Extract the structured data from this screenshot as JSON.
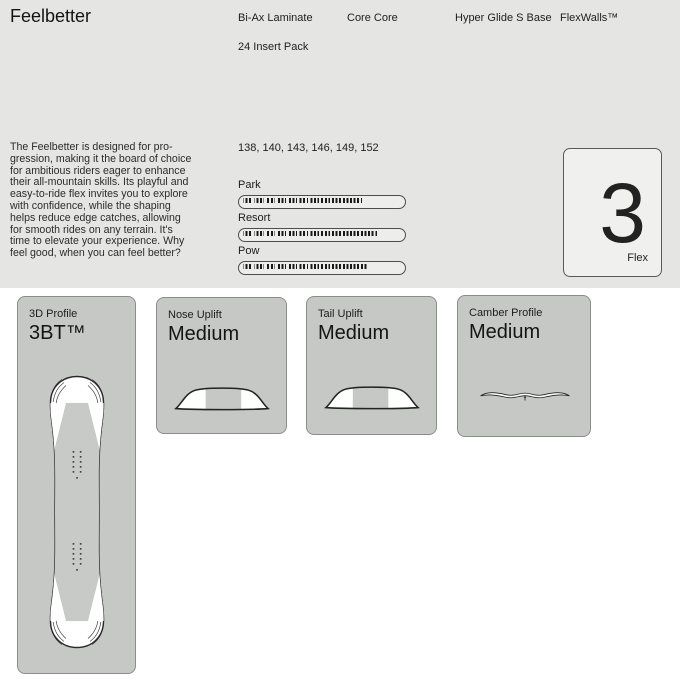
{
  "product": {
    "title": "Feelbetter",
    "features_row1": [
      "Bi-Ax Laminate",
      "Core Core",
      "Hyper Glide S Base",
      "FlexWalls™"
    ],
    "features_row2": [
      "24 Insert Pack"
    ],
    "sizes": "138, 140, 143, 146, 149, 152",
    "description": "The Feelbetter is designed for pro-\ngression, making it the board of choice\nfor ambitious riders eager to enhance\ntheir all-mountain skills. Its playful and\neasy-to-ride flex invites you to explore\nwith confidence, while the shaping\nhelps reduce edge catches, allowing\nfor smooth rides on any terrain. It's\ntime to elevate your experience. Why\nfeel good, when you can feel better?"
  },
  "ratings": [
    {
      "label": "Park",
      "percent": 75
    },
    {
      "label": "Resort",
      "percent": 85
    },
    {
      "label": "Pow",
      "percent": 79
    }
  ],
  "flex": {
    "value": "3",
    "label": "Flex"
  },
  "cards": [
    {
      "label": "3D Profile",
      "value": "3BT™"
    },
    {
      "label": "Nose Uplift",
      "value": "Medium"
    },
    {
      "label": "Tail Uplift",
      "value": "Medium"
    },
    {
      "label": "Camber Profile",
      "value": "Medium"
    }
  ],
  "colors": {
    "section_bg": "#e5e6e4",
    "page_bg": "#ffffff",
    "card_bg": "#c6c8c6",
    "card_border": "#8b8d8b",
    "bar_dash": "#191919",
    "text": "#1a1a1a"
  }
}
